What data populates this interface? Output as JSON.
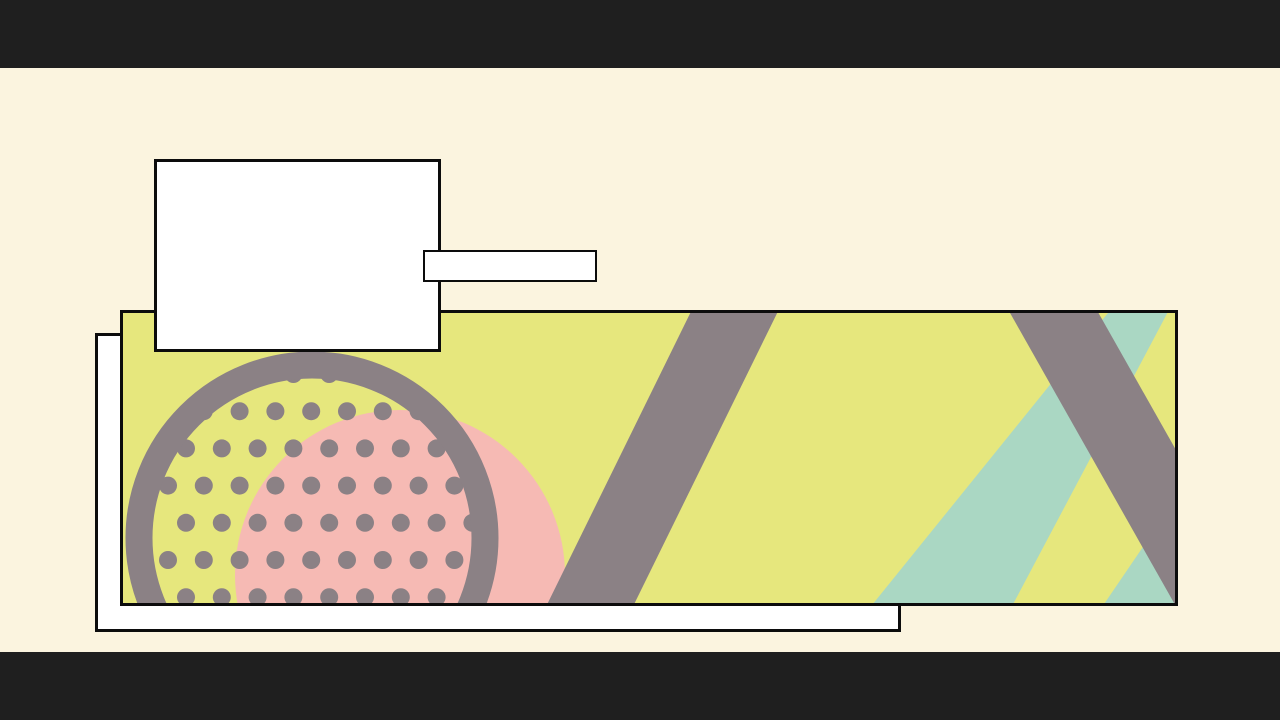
{
  "frame": {
    "width": 1280,
    "height": 720
  },
  "colors": {
    "letterbox": "#1f1f1f",
    "background": "#fbf4df",
    "panel_fill": "#ffffff",
    "outline": "#0c0c0c",
    "banner_fill": "#e6e77d",
    "gray": "#8b8185",
    "pink": "#f6bab4",
    "teal": "#aad7c3"
  },
  "artwork": {
    "pink_circle": {
      "cx": 400,
      "cy": 575,
      "r": 165
    },
    "teal_stripe_wide_points": "868,610 1010,610 1170,308 1112,308",
    "teal_stripe_narrow_points": "1100,610 1175,610 1292,438 1217,438",
    "gray_stripe_left": {
      "x1": 747,
      "y1": 286,
      "x2": 578,
      "y2": 630,
      "w": 78
    },
    "gray_stripe_right": {
      "x1": 1039,
      "y1": 286,
      "x2": 1233,
      "y2": 629,
      "w": 77
    },
    "ring": {
      "cx": 312,
      "cy": 538,
      "r": 173,
      "sw": 27
    },
    "dots": {
      "cx": 312,
      "cy": 538,
      "max_dist": 172,
      "r": 9,
      "y0": 374,
      "dy": 37.2,
      "rows": 7,
      "x0_even": 186,
      "x0_odd": 168,
      "dx": 35.8,
      "cols": 11
    }
  }
}
